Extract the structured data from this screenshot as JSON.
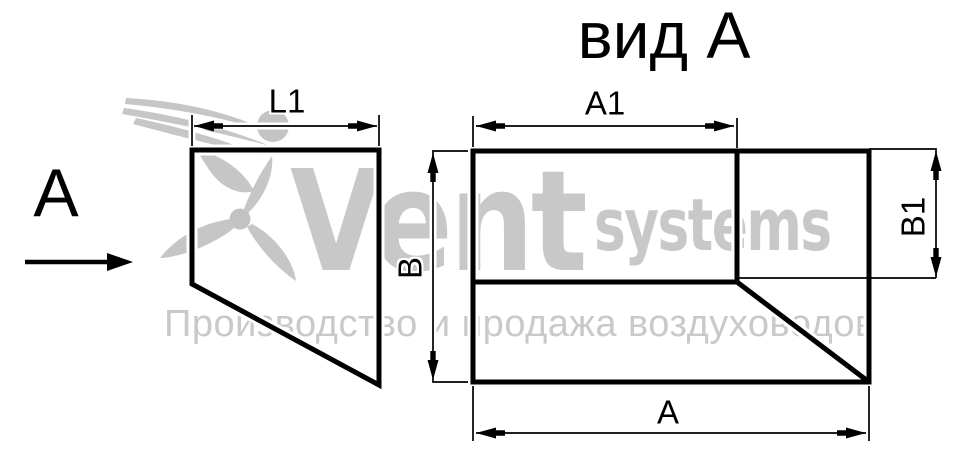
{
  "title": "вид А",
  "view_arrow": {
    "label": "А"
  },
  "dim_labels": {
    "l1": "L1",
    "a1": "A1",
    "b": "В",
    "b1": "В1",
    "a": "А"
  },
  "watermark": {
    "brand_primary": "Vent",
    "brand_secondary": "systems",
    "tagline": "Производство и продажа воздуховодов",
    "color": "#c8c8c8"
  },
  "colors": {
    "line": "#000000",
    "label": "#000000",
    "watermark_text": "#c8c8c8",
    "watermark_tagline": "#c9c9c9"
  }
}
